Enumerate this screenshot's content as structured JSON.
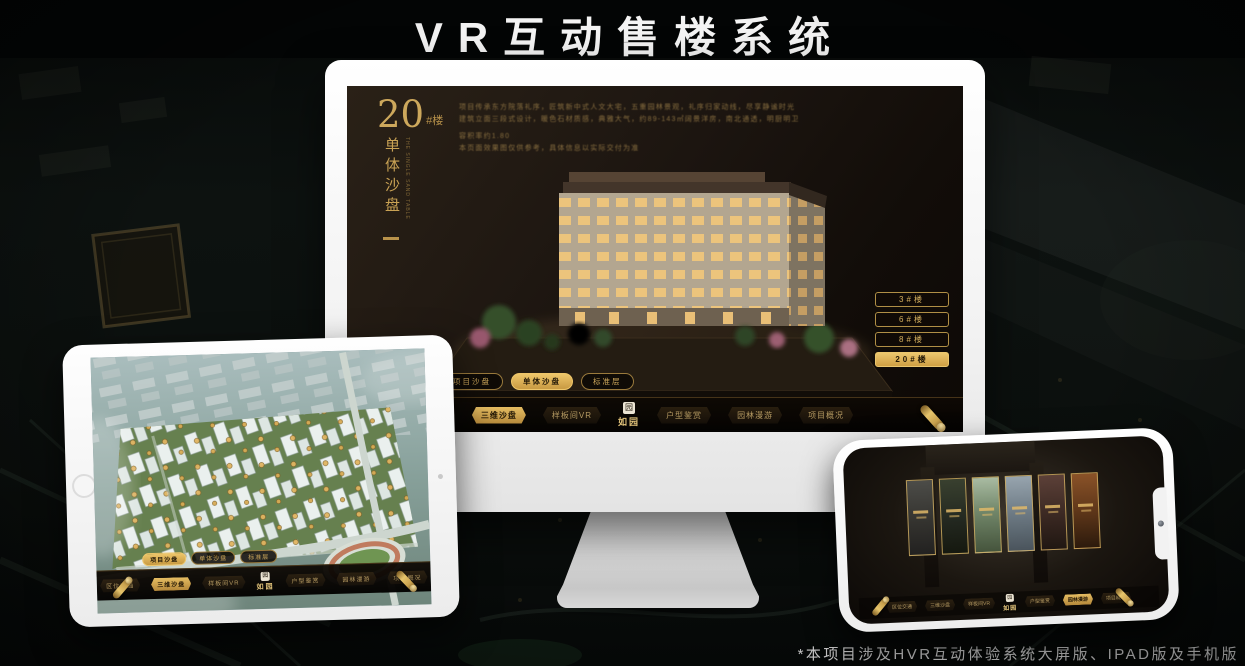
{
  "title": "VR互动售楼系统",
  "footnote": "*本项目涉及HVR互动体验系统大屏版、IPAD版及手机版",
  "colors": {
    "gold": "#d4af5e",
    "gold_dark": "#8a6f3a",
    "screen_bg": "#1c1510",
    "active_fill": "#e0b460"
  },
  "monitor": {
    "heading": {
      "number": "20",
      "suffix": "#楼",
      "vertical_title": "单体沙盘",
      "vertical_subtitle": "THE SINGLE SAND TABLE"
    },
    "description_lines": [
      "项目传承东方院落礼序，匠筑新中式人文大宅，五重园林景观，礼序归家动线，尽享静谧时光",
      "建筑立面三段式设计，暖色石材质感，典雅大气，约89-143㎡阔景洋房，南北通透，明厨明卫",
      "容积率约1.80",
      "本页面效果图仅供参考，具体信息以实际交付为准"
    ],
    "floor_buttons": [
      {
        "label": "3#楼"
      },
      {
        "label": "6#楼"
      },
      {
        "label": "8#楼"
      },
      {
        "label": "20#楼"
      }
    ],
    "sub_tabs": [
      {
        "label": "项目沙盘"
      },
      {
        "label": "单体沙盘"
      },
      {
        "label": "标准层"
      }
    ],
    "nav": {
      "items": [
        {
          "label": "区位交通"
        },
        {
          "label": "三维沙盘"
        },
        {
          "label": "样板间VR"
        },
        {
          "label": "户型鉴赏"
        },
        {
          "label": "园林漫游"
        },
        {
          "label": "项目概况"
        }
      ],
      "logo": {
        "seal": "园",
        "name": "如园"
      }
    }
  },
  "tablet": {
    "sub_tabs": [
      {
        "label": "项目沙盘"
      },
      {
        "label": "单体沙盘"
      },
      {
        "label": "标准层"
      }
    ],
    "nav": {
      "items": [
        {
          "label": "区位交通"
        },
        {
          "label": "三维沙盘"
        },
        {
          "label": "样板间VR"
        },
        {
          "label": "户型鉴赏"
        },
        {
          "label": "园林漫游"
        },
        {
          "label": "项目概况"
        }
      ],
      "logo": {
        "seal": "园",
        "name": "如园"
      }
    }
  },
  "phone": {
    "nav": {
      "items": [
        {
          "label": "区位交通"
        },
        {
          "label": "三维沙盘"
        },
        {
          "label": "样板间VR"
        },
        {
          "label": "户型鉴赏"
        },
        {
          "label": "园林漫游"
        },
        {
          "label": "项目概况"
        }
      ],
      "logo": {
        "seal": "园",
        "name": "如园"
      }
    }
  }
}
